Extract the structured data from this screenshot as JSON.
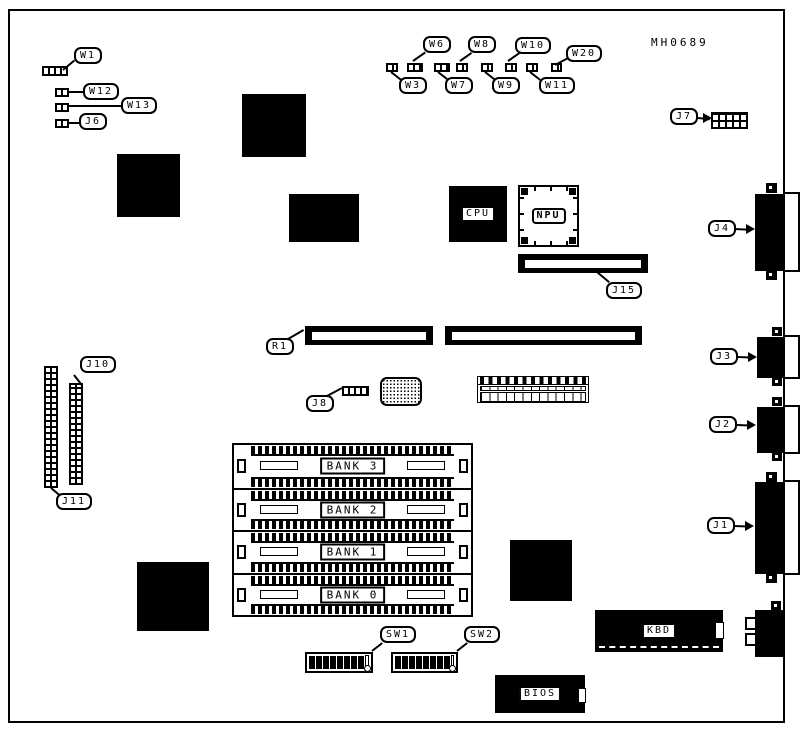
{
  "board": {
    "part_number": "MH0689",
    "colors": {
      "ink": "#000000",
      "paper": "#ffffff"
    }
  },
  "callouts": {
    "w1": "W1",
    "w12": "W12",
    "w13": "W13",
    "j6": "J6",
    "w3": "W3",
    "w6": "W6",
    "w7": "W7",
    "w8": "W8",
    "w9": "W9",
    "w10": "W10",
    "w11": "W11",
    "w20": "W20",
    "j7": "J7",
    "j15": "J15",
    "r1": "R1",
    "j8": "J8",
    "j10": "J10",
    "j11": "J11",
    "j1": "J1",
    "j2": "J2",
    "j3": "J3",
    "j4": "J4",
    "sw1": "SW1",
    "sw2": "SW2"
  },
  "chips": {
    "cpu": "CPU",
    "npu": "NPU",
    "kbd": "KBD",
    "bios": "BIOS"
  },
  "banks": [
    {
      "label": "BANK 3"
    },
    {
      "label": "BANK 2"
    },
    {
      "label": "BANK 1"
    },
    {
      "label": "BANK 0"
    }
  ]
}
